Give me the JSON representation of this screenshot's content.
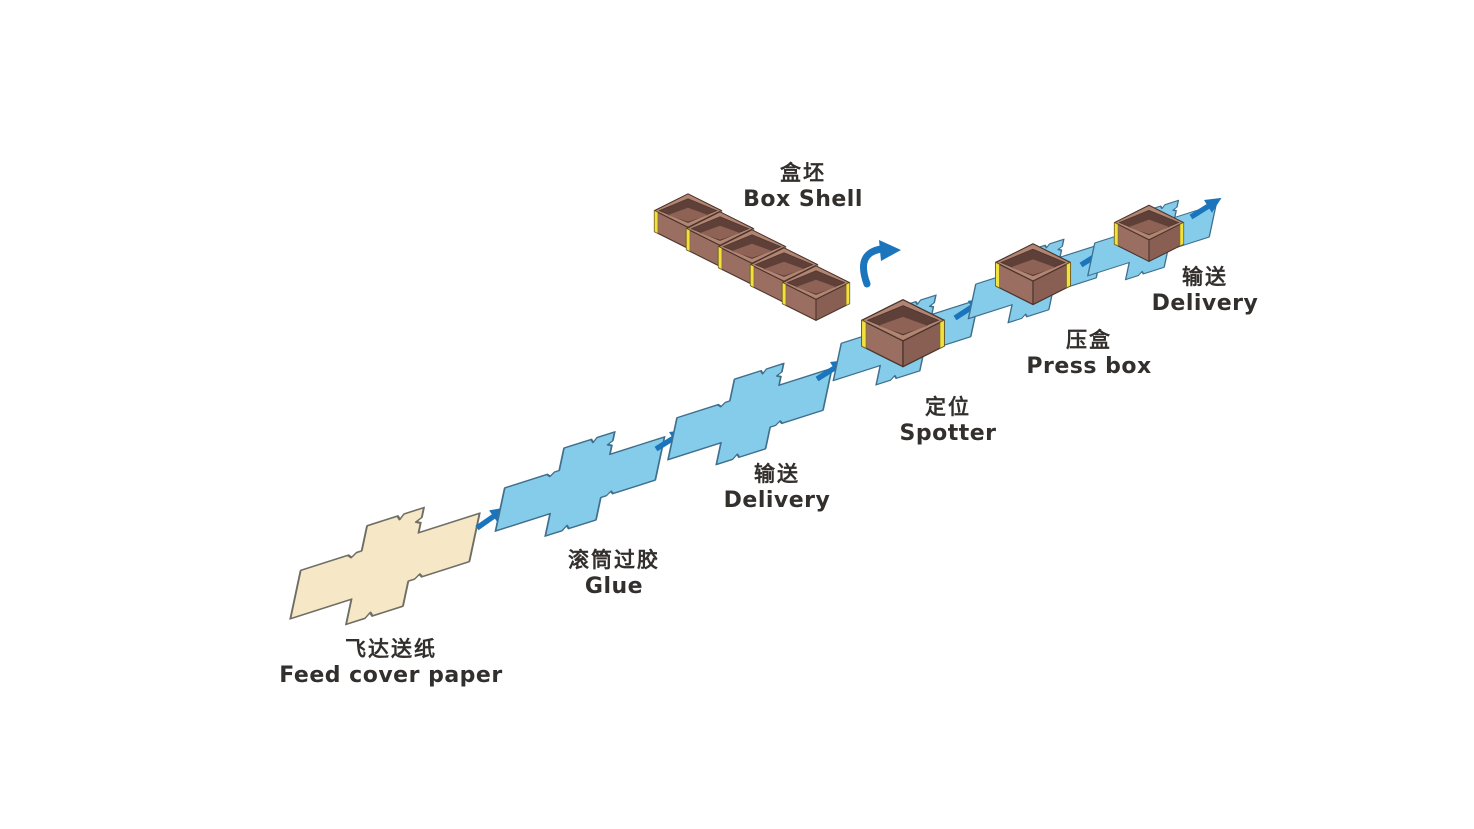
{
  "diagram": {
    "title_implicit": "box making process flow",
    "stages": [
      {
        "id": "feed",
        "zh": "飞达送纸",
        "en": "Feed cover paper",
        "type": "paper-blank"
      },
      {
        "id": "glue",
        "zh": "滚筒过胶",
        "en": "Glue",
        "type": "blue-blank"
      },
      {
        "id": "delivery1",
        "zh": "输送",
        "en": "Delivery",
        "type": "blue-blank"
      },
      {
        "id": "spotter",
        "zh": "定位",
        "en": "Spotter",
        "type": "box-on-blank"
      },
      {
        "id": "pressbox",
        "zh": "压盒",
        "en": "Press box",
        "type": "box-on-blank"
      },
      {
        "id": "delivery2",
        "zh": "输送",
        "en": "Delivery",
        "type": "box-on-blank"
      },
      {
        "id": "boxshell",
        "zh": "盒坯",
        "en": "Box Shell",
        "type": "box-row",
        "box_count": 5
      }
    ],
    "flow_arrow_count": 6,
    "icons": {
      "flow_arrow": "straight arrow pointing up-right",
      "flip_arrow": "curved arrow pointing up-right"
    },
    "colors": {
      "background": "#FFFFFF",
      "blank_cream_fill": "#F6E8C6",
      "blank_cream_stroke": "#6E6E64",
      "blank_blue_fill": "#85CBEA",
      "blank_blue_stroke": "#3F6F8C",
      "box_face_left": "#9A6E61",
      "box_face_right": "#8A5F53",
      "box_rim_top": "#B28573",
      "box_inner_dark": "#5F4038",
      "box_floor": "#8E6356",
      "box_outline": "#4A342C",
      "corner_strip_yellow": "#F2E23D",
      "arrow_blue": "#1B75BC",
      "text": "#332F2D"
    }
  }
}
